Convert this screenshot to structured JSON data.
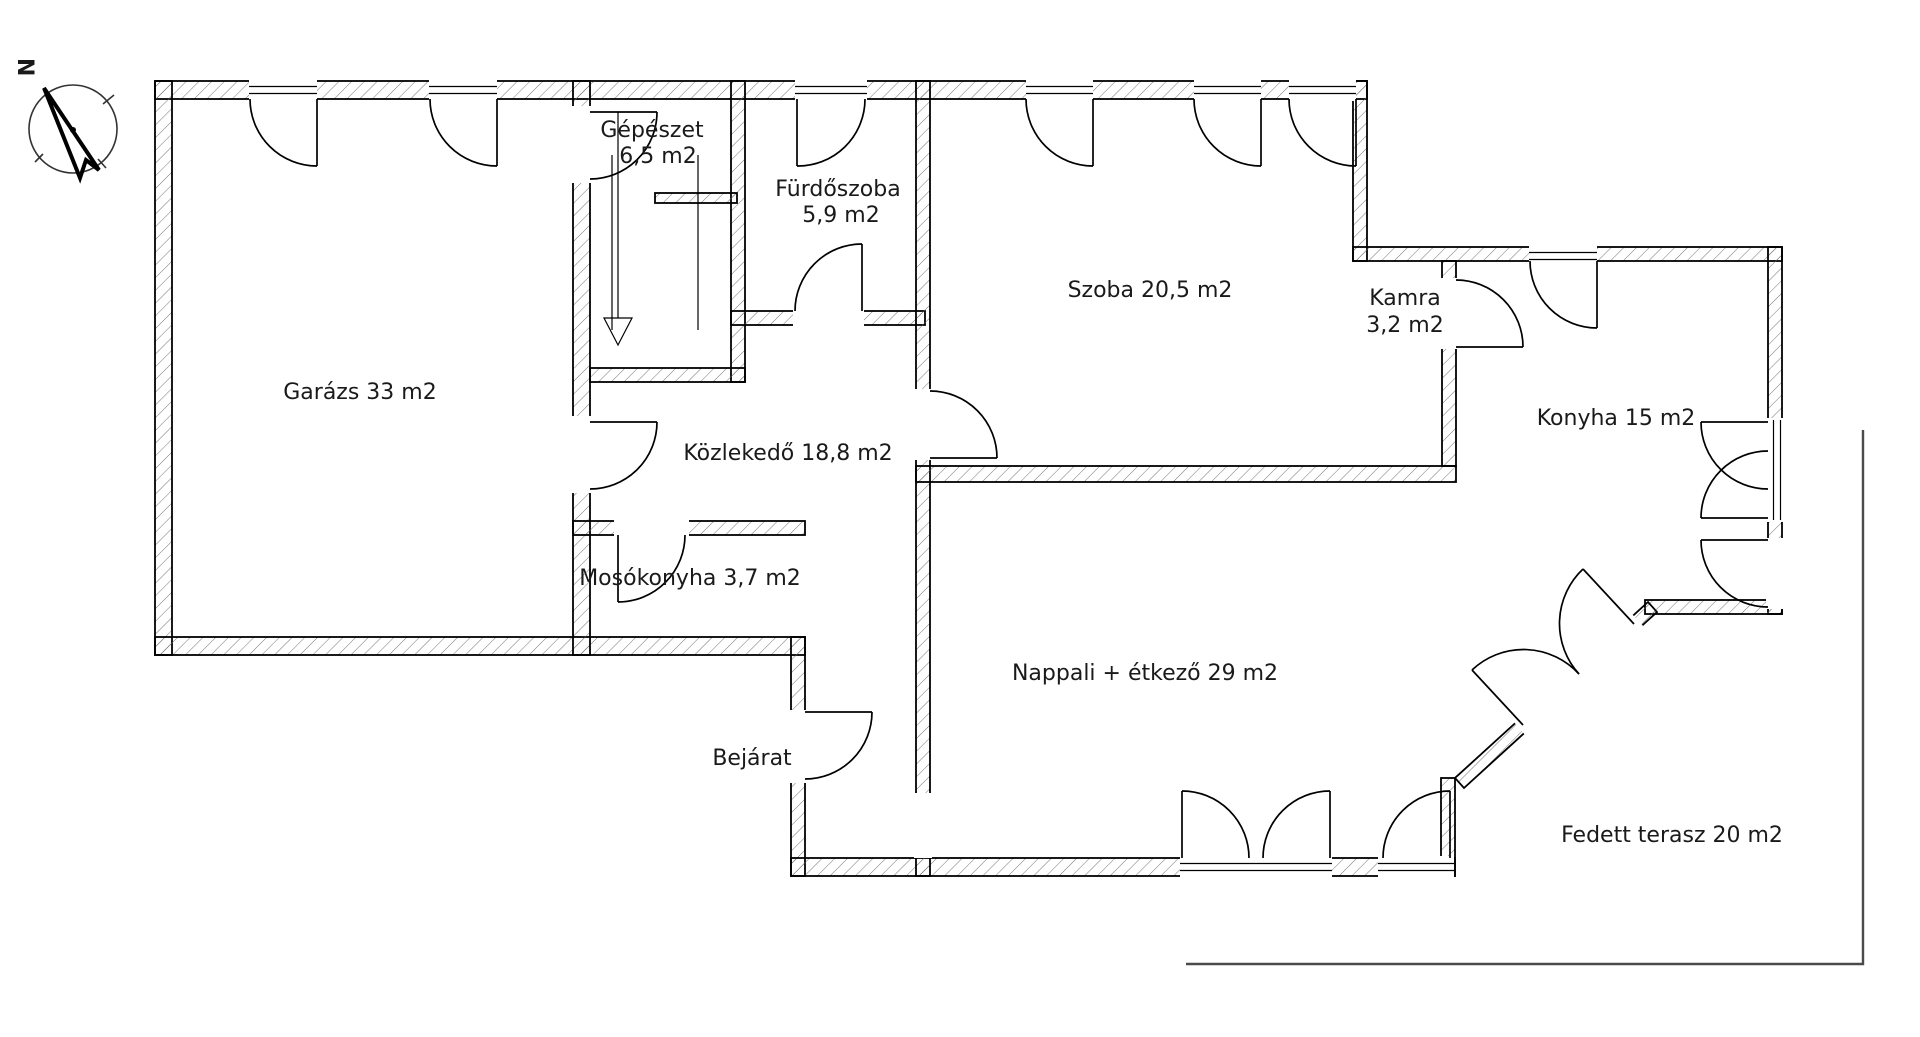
{
  "title": "Floor plan",
  "compass": {
    "north_label": "N"
  },
  "rooms": {
    "garage": {
      "label": "Garázs 33 m2"
    },
    "mechanical": {
      "name": "Gépészet",
      "area": "6,5 m2"
    },
    "bathroom": {
      "name": "Fürdőszoba",
      "area": "5,9 m2"
    },
    "bedroom": {
      "label": "Szoba 20,5 m2"
    },
    "pantry": {
      "name": "Kamra",
      "area": "3,2 m2"
    },
    "kitchen": {
      "label": "Konyha 15 m2"
    },
    "hallway": {
      "label": "Közlekedő 18,8 m2"
    },
    "laundry": {
      "label": "Mosókonyha 3,7 m2"
    },
    "living_dining": {
      "label": "Nappali + étkező 29 m2"
    },
    "entrance": {
      "label": "Bejárat"
    },
    "covered_terrace": {
      "label": "Fedett terasz 20 m2"
    }
  },
  "colors": {
    "background": "#ffffff",
    "wall_line": "#000000",
    "hatch_line": "#666666",
    "text": "#1a1a1a",
    "terrace_line": "#4a4a4a"
  }
}
